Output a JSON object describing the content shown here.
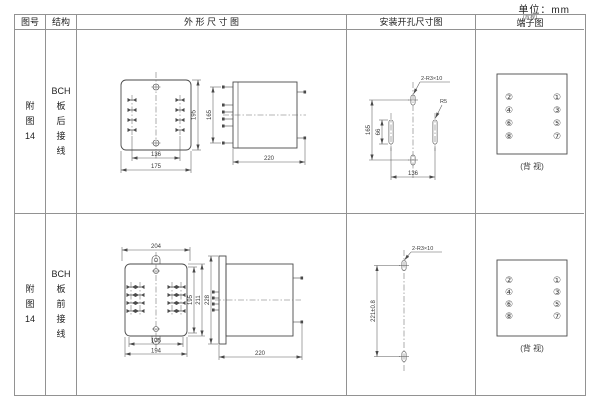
{
  "unit_label": "单位：mm",
  "header": {
    "figure": "图号",
    "structure": "结构",
    "outline": "外 形 尺 寸 图",
    "mounting": "安装开孔尺寸图",
    "terminal": "端子图",
    "terminal_note": "(背视)"
  },
  "rows": [
    {
      "figure_no": "附\n图\n14",
      "structure": "BCH\n板\n后\n接\n线",
      "outline_dims": {
        "width_inner": "136",
        "width_outer": "175",
        "height": "195",
        "stud_span": "165",
        "depth": "220"
      },
      "mounting_dims": {
        "hole_label": "2-R3×10",
        "slot_radius": "R5",
        "height": "165",
        "slot_length": "66",
        "width": "136"
      },
      "terminal": {
        "left": [
          "②",
          "④",
          "⑥",
          "⑧"
        ],
        "right": [
          "①",
          "③",
          "⑤",
          "⑦"
        ],
        "caption": "(背 视)"
      }
    },
    {
      "figure_no": "附\n图\n14",
      "structure": "BCH\n板\n前\n接\n线",
      "outline_dims": {
        "width_top": "204",
        "width_inner": "175",
        "width_outer": "194",
        "height_inner": "195",
        "height_mid": "211",
        "height_outer": "228",
        "depth": "220"
      },
      "mounting_dims": {
        "hole_label": "2-R3×10",
        "height": "221±0.8"
      },
      "terminal": {
        "left": [
          "②",
          "④",
          "⑥",
          "⑧"
        ],
        "right": [
          "①",
          "③",
          "⑤",
          "⑦"
        ],
        "caption": "(背 视)"
      }
    }
  ]
}
